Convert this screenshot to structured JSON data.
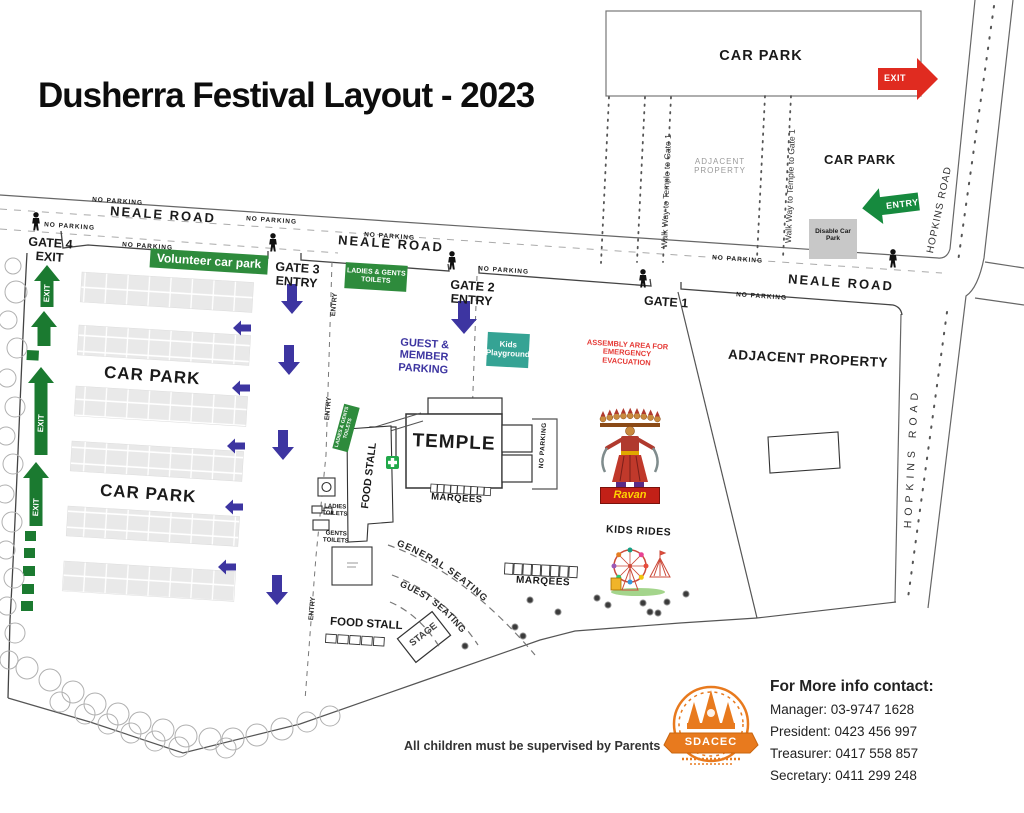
{
  "title": "Dusherra Festival Layout - 2023",
  "roads": {
    "neale": "NEALE ROAD",
    "hopkins": "HOPKINS ROAD",
    "no_parking": "NO PARKING"
  },
  "top_right": {
    "car_park_main": "CAR PARK",
    "car_park_small": "CAR PARK",
    "exit_arrow": "EXIT",
    "entry_arrow": "ENTRY",
    "walkway": "Walk Way to Temple to Gate 1",
    "adjacent_property": "ADJACENT PROPERTY",
    "disable_car_park": "Disable Car Park"
  },
  "gates": {
    "gate1": "GATE 1",
    "gate2": "GATE 2",
    "gate3": "GATE 3",
    "gate4": "GATE 4",
    "entry": "ENTRY",
    "exit": "EXIT"
  },
  "car_park": {
    "label": "CAR PARK",
    "volunteer_banner": "Volunteer car park",
    "exit": "EXIT"
  },
  "facilities": {
    "ladies_gents_toilets": "LADIES & GENTS TOILETS",
    "ladies_toilets": "LADIES TOILETS",
    "gents_toilets": "GENTS TOILETS",
    "guest_member_parking": "GUEST & MEMBER PARKING",
    "kids_playground": "Kids Playground",
    "assembly_area": "ASSEMBLY AREA FOR EMERGENCY EVACUATION",
    "temple": "TEMPLE",
    "marqees": "MARQEES",
    "food_stall": "FOOD STALL",
    "no_parking": "NO PARKING",
    "entry": "ENTRY",
    "general_seating": "GENERAL SEATING",
    "guest_seating": "GUEST SEATING",
    "stage": "STAGE",
    "ravan": "Ravan",
    "kids_rides": "KIDS RIDES",
    "adjacent_property": "ADJACENT PROPERTY"
  },
  "footer": {
    "children_notice": "All children must be supervised by Parents",
    "logo_text": "SDACEC",
    "contact_heading": "For More info contact:",
    "contact_lines": [
      "Manager: 03-9747 1628",
      "President: 0423 456 997",
      "Treasurer: 0417 558 857",
      "Secretary: 0411 299 248"
    ]
  },
  "colors": {
    "arrow_green": "#1b7a30",
    "banner_green": "#2e8b3c",
    "indigo": "#3d35a1",
    "teal": "#35a394",
    "red": "#e02b20",
    "assembly_red": "#e53935",
    "logo_orange": "#e87a1e"
  }
}
